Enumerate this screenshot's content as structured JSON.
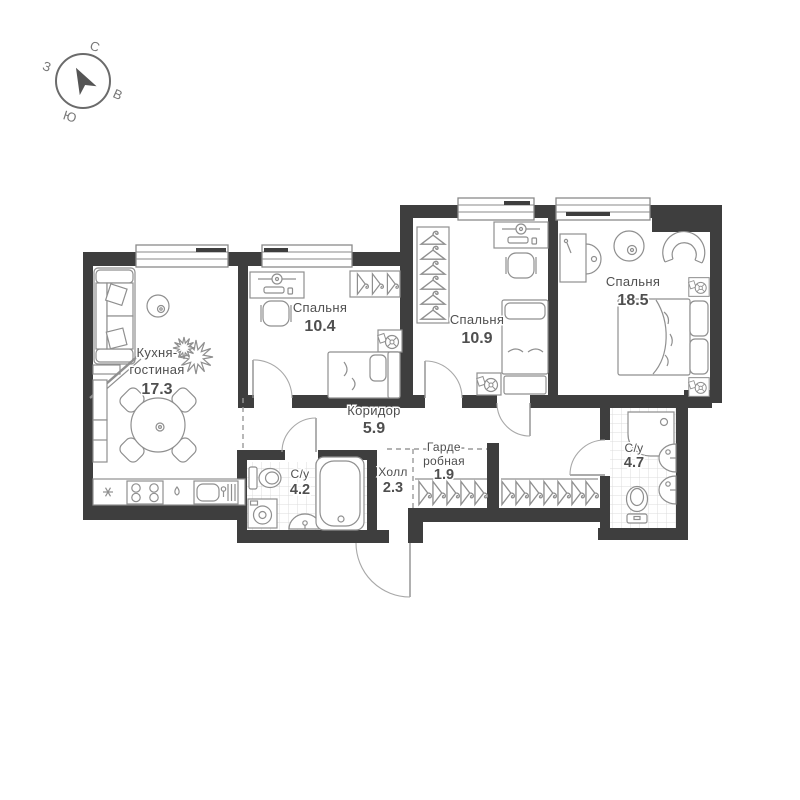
{
  "title": "Планировка квартиры",
  "compass": {
    "north": "С",
    "east": "В",
    "south": "Ю",
    "west": "З"
  },
  "rooms": {
    "kitchen": {
      "name_line1": "Кухня-",
      "name_line2": "гостиная",
      "area": "17.3"
    },
    "bedroom_small": {
      "name": "Спальня",
      "area": "10.4"
    },
    "bedroom_mid": {
      "name": "Спальня",
      "area": "10.9"
    },
    "bedroom_large": {
      "name": "Спальня",
      "area": "18.5"
    },
    "corridor": {
      "name": "Коридор",
      "area": "5.9"
    },
    "hall": {
      "name": "Холл",
      "area": "2.3"
    },
    "wardrobe": {
      "name_line1": "Гарде-",
      "name_line2": "робная",
      "area": "1.9"
    },
    "bath_small": {
      "name": "С/у",
      "area": "4.2"
    },
    "bath_large": {
      "name": "С/у",
      "area": "4.7"
    }
  },
  "colors": {
    "wall": "#3e3e3e",
    "furniture": "#8f8f8f",
    "label": "#4f4f4f",
    "dashed_zone": "#9a9a9a",
    "tile_grid": "#dcdcdc",
    "background": "#ffffff"
  }
}
